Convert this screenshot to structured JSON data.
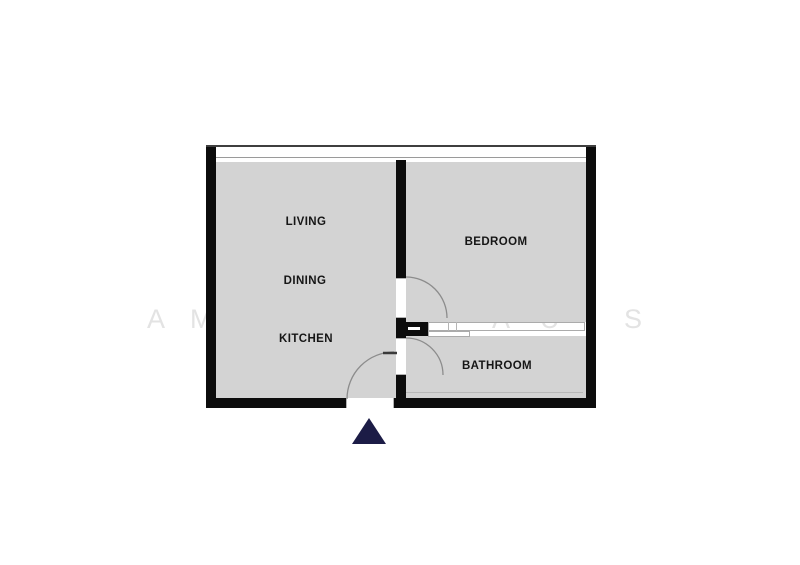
{
  "floorplan": {
    "rooms": {
      "living": {
        "label": "LIVING"
      },
      "dining": {
        "label": "DINING"
      },
      "kitchen": {
        "label": "KITCHEN"
      },
      "bedroom": {
        "label": "BEDROOM"
      },
      "bathroom": {
        "label": "BATHROOM"
      }
    },
    "watermark": {
      "letters": [
        "A",
        "M",
        "A",
        "U",
        "S"
      ]
    },
    "entrance_marker": {
      "shape": "triangle-up"
    },
    "colors": {
      "room_fill": "#d3d3d3",
      "wall": "#0c0c0c",
      "door_arc": "#8c8c8c",
      "window_line": "#3f3f3f",
      "watermark": "#e3e3e3",
      "entrance_marker": "#1c1c46",
      "label_text": "#161616",
      "background": "#ffffff"
    }
  }
}
